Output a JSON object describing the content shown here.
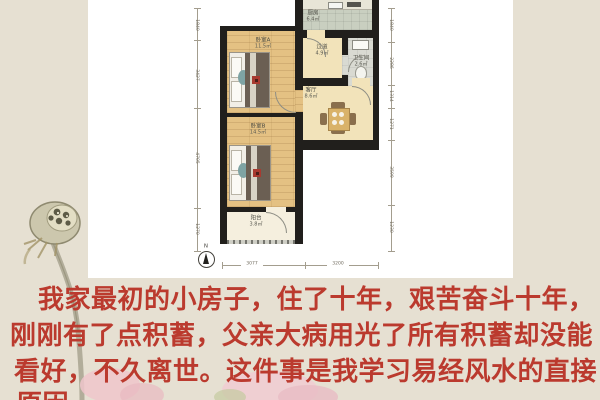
{
  "page": {
    "background_color": "#e6e0d2",
    "sheet_color": "#ffffff"
  },
  "floor_plan": {
    "rooms": [
      {
        "id": "kitchen",
        "label": "厨房",
        "area": "6.4㎡"
      },
      {
        "id": "bedroom_a",
        "label": "卧室A",
        "area": "11.5㎡"
      },
      {
        "id": "hallway",
        "label": "过道",
        "area": "4.9㎡"
      },
      {
        "id": "bathroom",
        "label": "卫生间",
        "area": "2.6㎡"
      },
      {
        "id": "living",
        "label": "客厅",
        "area": "8.6㎡"
      },
      {
        "id": "bedroom_b",
        "label": "卧室B",
        "area": "14.5㎡"
      },
      {
        "id": "balcony",
        "label": "阳台",
        "area": "3.8㎡"
      }
    ],
    "dimensions": {
      "left": [
        "1840",
        "3427",
        "4705",
        "1270"
      ],
      "right": [
        "1840",
        "2286",
        "1314",
        "1271",
        "3599",
        "1230"
      ],
      "bottom": [
        "3077",
        "3200"
      ]
    },
    "north_label": "N",
    "wall_color": "#211f1c"
  },
  "caption": {
    "color": "#bb3a2e",
    "lines": [
      "我家最初的小房子，住了十年，艰苦奋斗十年，",
      "刚刚有了点积蓄，父亲大病用光了所有积蓄却没能",
      "看好，不久离世。这件事是我学习易经风水的直接",
      "原因"
    ]
  }
}
